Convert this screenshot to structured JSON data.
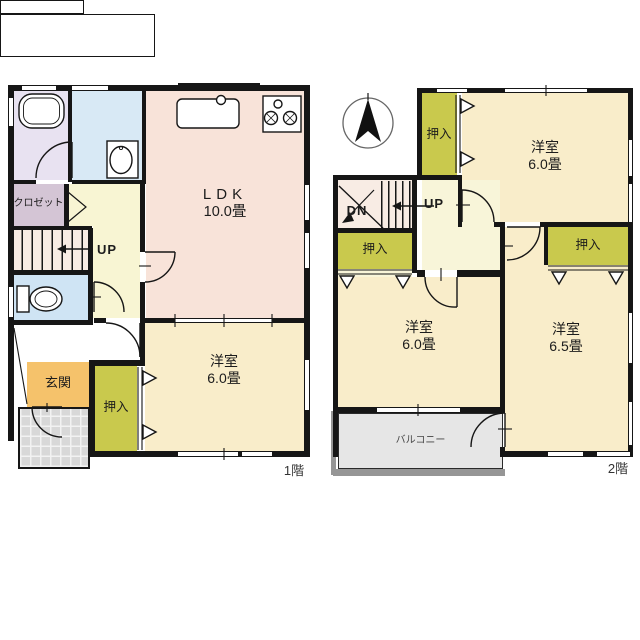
{
  "floor1": {
    "label": "1階",
    "ldk": {
      "name": "LDK",
      "size": "10.0畳"
    },
    "bedroom": {
      "name": "洋室",
      "size": "6.0畳"
    },
    "genkan": "玄関",
    "closet": "クロゼット",
    "oshiire": "押入",
    "up": "UP"
  },
  "floor2": {
    "label": "2階",
    "bedroom_ne": {
      "name": "洋室",
      "size": "6.0畳"
    },
    "bedroom_sw": {
      "name": "洋室",
      "size": "6.0畳"
    },
    "bedroom_se": {
      "name": "洋室",
      "size": "6.5畳"
    },
    "oshiire_top": "押入",
    "oshiire_mid": "押入",
    "oshiire_right": "押入",
    "balcony": "バルコニー",
    "up": "UP",
    "dn": "DN"
  },
  "colors": {
    "wall": "#161616",
    "ldk": "#f8e3d9",
    "bedroom_cream": "#f9edca",
    "oshiire_olive": "#c9c94d",
    "hallway_yellow": "#f8f5d3",
    "bath_lavender": "#e8e2f1",
    "washroom_blue": "#d8e9f5",
    "toilet_blue": "#cfe4f4",
    "closet_mauve": "#d4c5d5",
    "genkan_orange": "#f5c26b",
    "balcony_gray": "#e6e6e6",
    "porch_tile": "#d8d8d8"
  }
}
